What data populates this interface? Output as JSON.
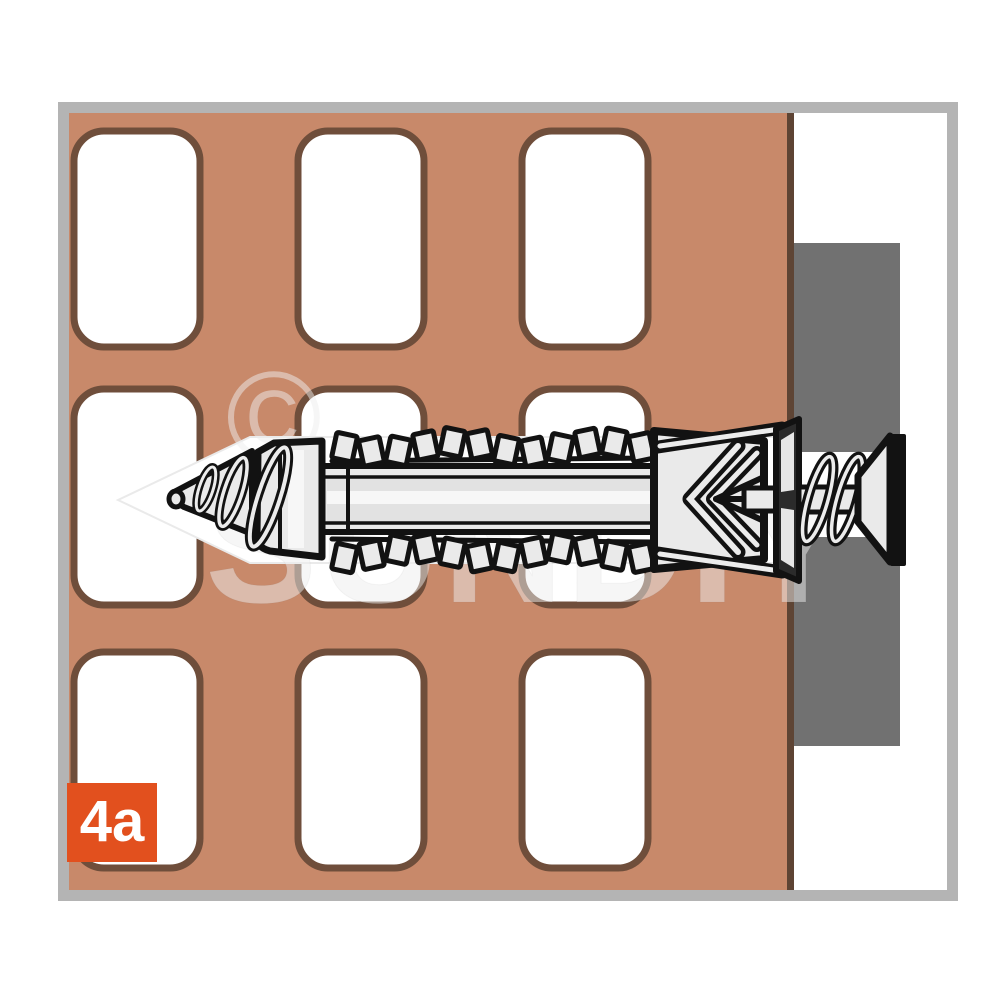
{
  "illustration": {
    "step_label": "4a",
    "watermark": {
      "copyright": "©",
      "text": "SUNDIY"
    },
    "colors": {
      "brick": "#C8896A",
      "hole_border": "#6F4E3B",
      "brick_edge": "#5E4434",
      "fixture": "#717171",
      "frame": "#B4B4B4",
      "badge": "#E2501E",
      "ink": "#121212",
      "plug_fill": "#EAEAEA",
      "channel": "#FFFFFF"
    },
    "icons": {
      "channel_arrow": "left-arrow-drill-channel-icon",
      "plug": "wall-plug-icon",
      "screw": "countersunk-screw-icon"
    }
  }
}
